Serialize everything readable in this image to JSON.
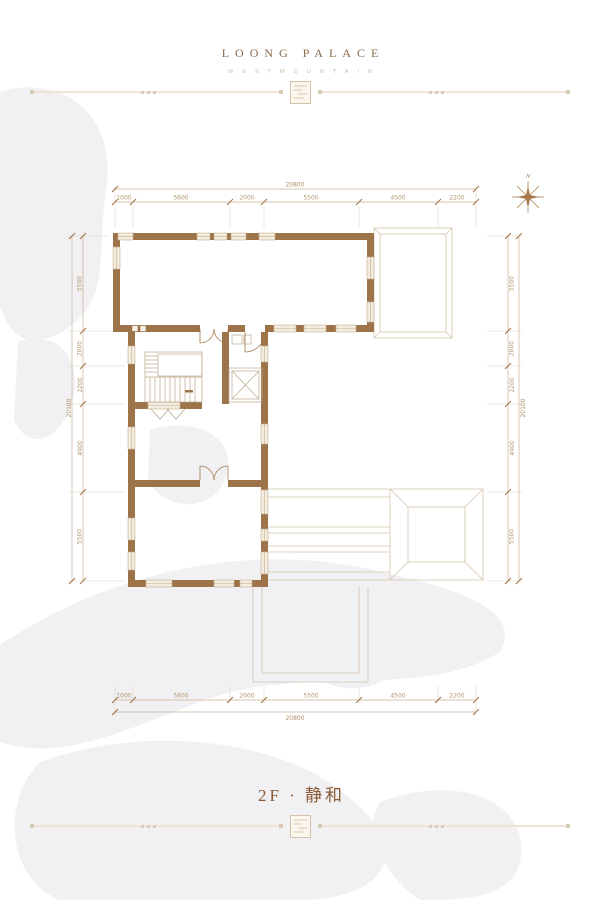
{
  "header": {
    "title": "LOONG PALACE",
    "subtitle": "WESTMOUNTAIN"
  },
  "floor": {
    "title": "2F · 静和"
  },
  "compass": {
    "north": "N"
  },
  "plan": {
    "dims": {
      "top": {
        "total": "20800",
        "segments": [
          "1000",
          "5600",
          "2000",
          "5500",
          "4500",
          "2200"
        ]
      },
      "bottom": {
        "total": "20800",
        "segments": [
          "1000",
          "5600",
          "2000",
          "5500",
          "4500",
          "2200"
        ]
      },
      "left": {
        "total": "20100",
        "segments": [
          "5500",
          "2000",
          "2200",
          "4900",
          "5500"
        ]
      },
      "right": {
        "total": "20100",
        "segments": [
          "5500",
          "2000",
          "2200",
          "4900",
          "5500"
        ]
      }
    }
  },
  "colors": {
    "wall": "#9d7449",
    "roof_line": "#d4c4ac",
    "dim_line": "#c8b294",
    "brand": "#8b6948",
    "floor_accent": "#8a5a36"
  }
}
